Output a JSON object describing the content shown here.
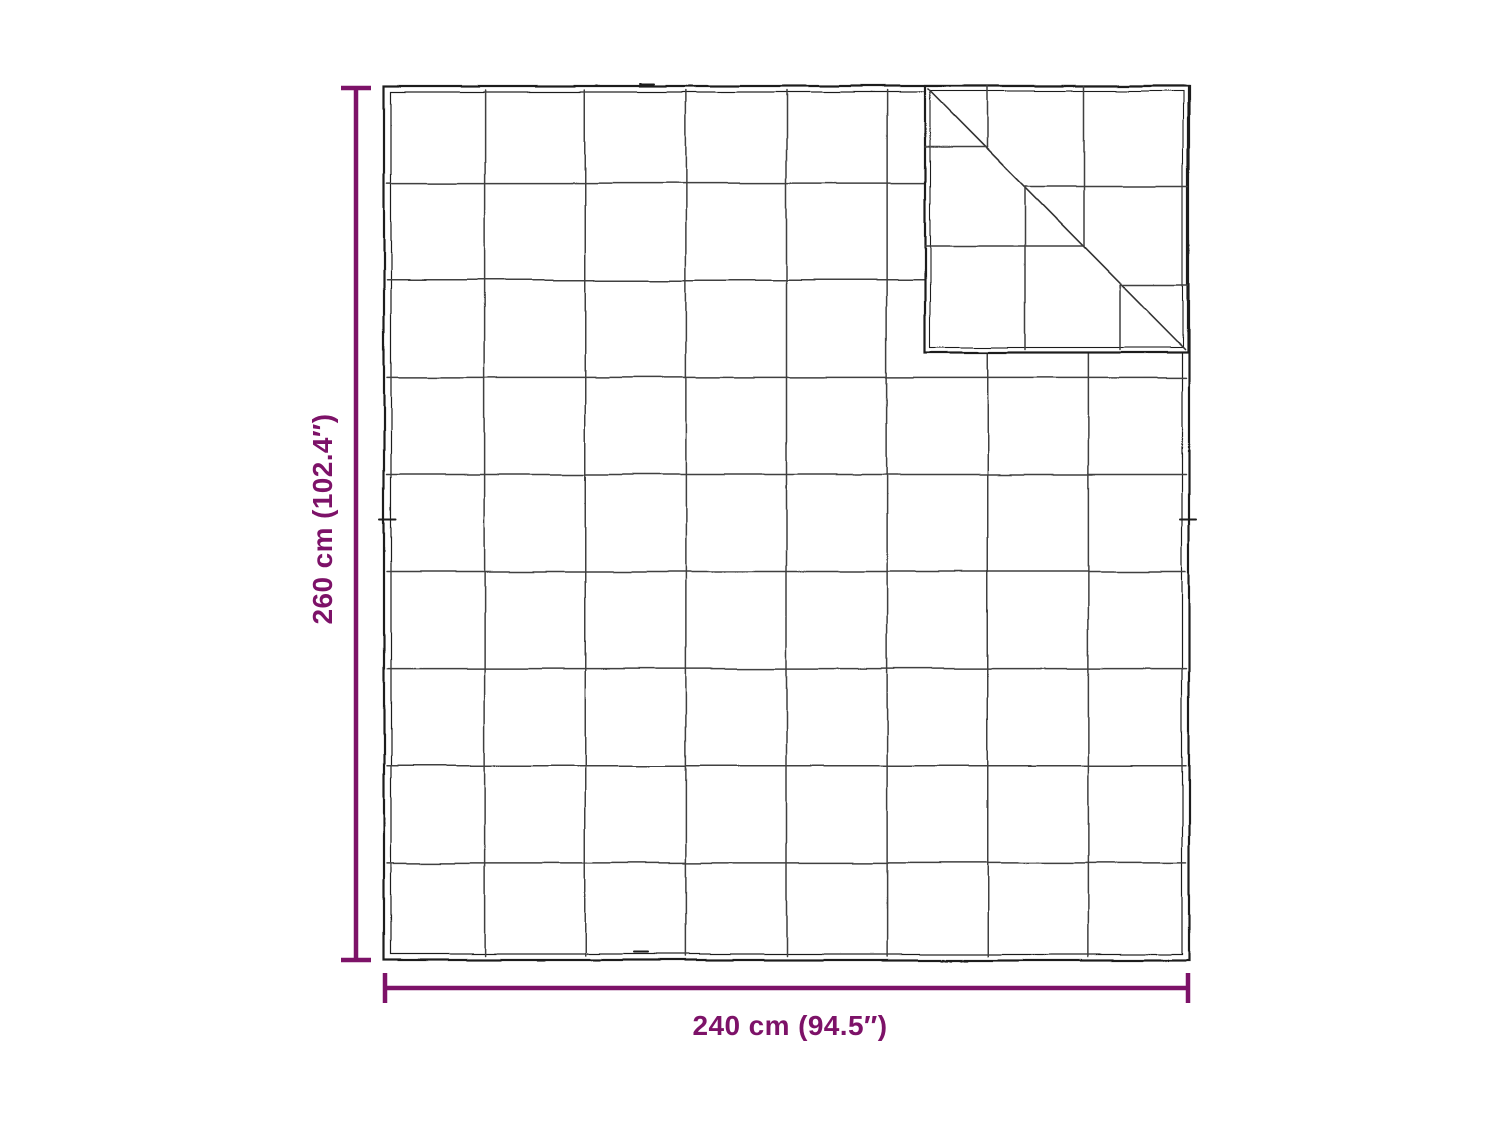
{
  "diagram": {
    "kind": "product-dimension-diagram",
    "subject": "quilted-blanket-top-view-with-folded-corner",
    "background": "#ffffff",
    "accent_color": "#7d1268",
    "outline_color": "#1e1e1e",
    "grid_color": "#3f3f3f",
    "height_label": "260 cm (102.4″)",
    "width_label": "240 cm (94.5″)",
    "grid": {
      "columns": 8,
      "rows": 9
    },
    "folded_corner": {
      "position": "top-right"
    }
  }
}
